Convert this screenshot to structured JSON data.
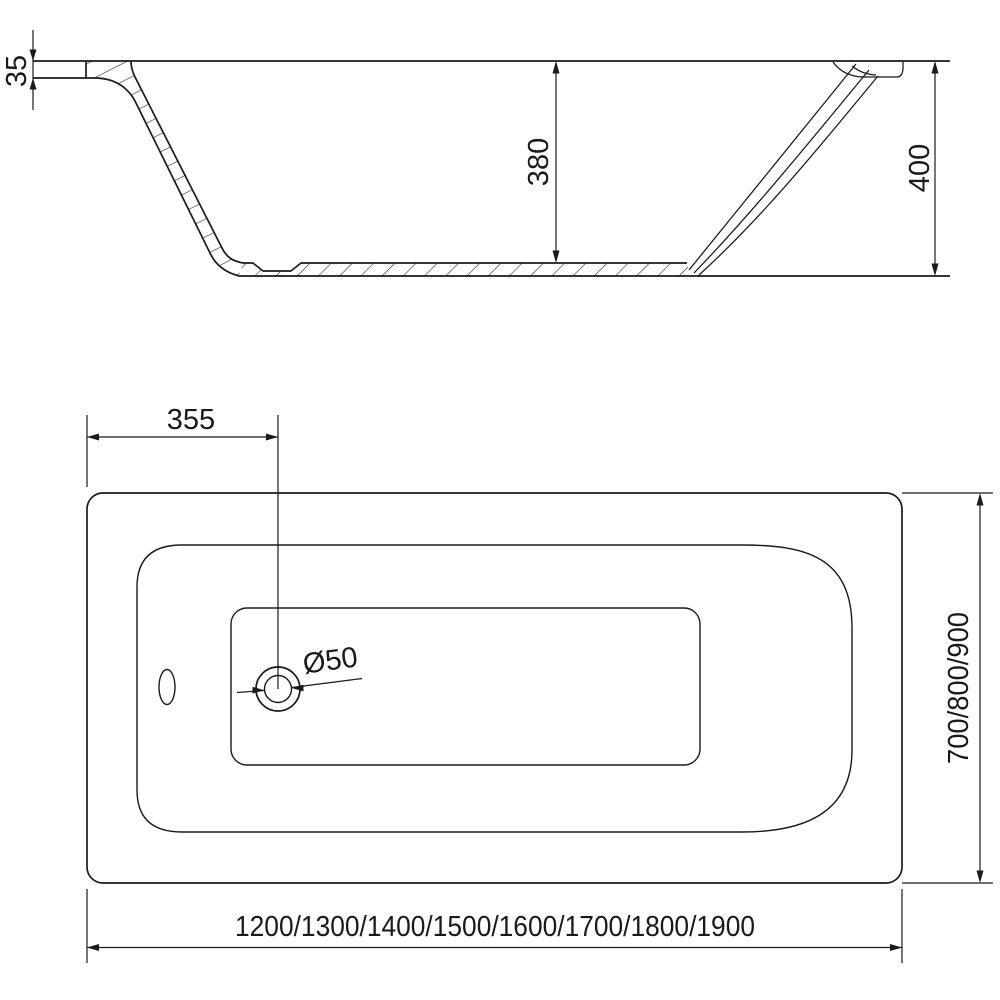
{
  "colors": {
    "line": "#1a1a1a",
    "background": "#ffffff"
  },
  "side_view": {
    "rim_thickness": "35",
    "inner_depth": "380",
    "overall_height": "400"
  },
  "top_view": {
    "drain_offset": "355",
    "drain_diameter": "Ø50",
    "width_options": "700/800/900",
    "length_options": "1200/1300/1400/1500/1600/1700/1800/1900"
  }
}
